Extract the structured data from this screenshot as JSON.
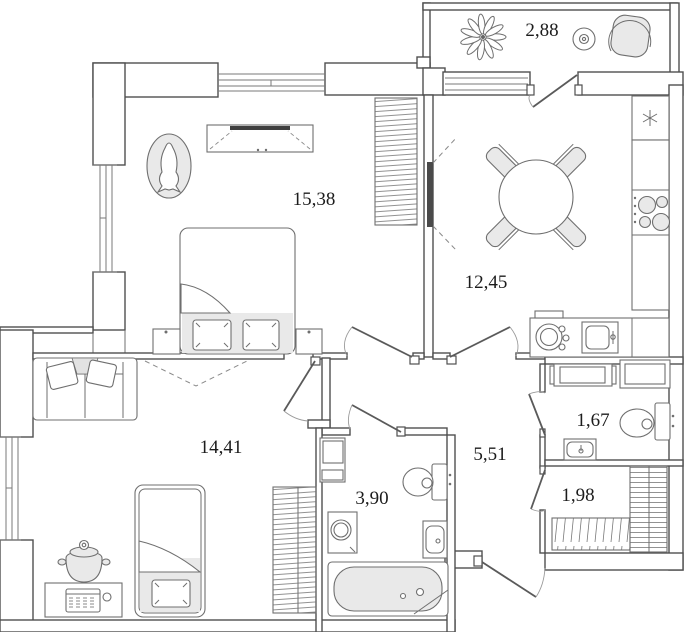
{
  "rooms": [
    {
      "name": "balcony",
      "area_label": "2,88"
    },
    {
      "name": "bedroom",
      "area_label": "15,38"
    },
    {
      "name": "kitchen",
      "area_label": "12,45"
    },
    {
      "name": "living-room",
      "area_label": "14,41"
    },
    {
      "name": "hallway",
      "area_label": "5,51"
    },
    {
      "name": "bathroom",
      "area_label": "3,90"
    },
    {
      "name": "toilet",
      "area_label": "1,67"
    },
    {
      "name": "storage",
      "area_label": "1,98"
    }
  ],
  "colors": {
    "wall_stroke": "#4f4f4f",
    "furniture_stroke": "#6f6f6f",
    "background": "#ffffff",
    "shade_fill": "#e9e9e9",
    "label_text": "#1c1c1c"
  }
}
